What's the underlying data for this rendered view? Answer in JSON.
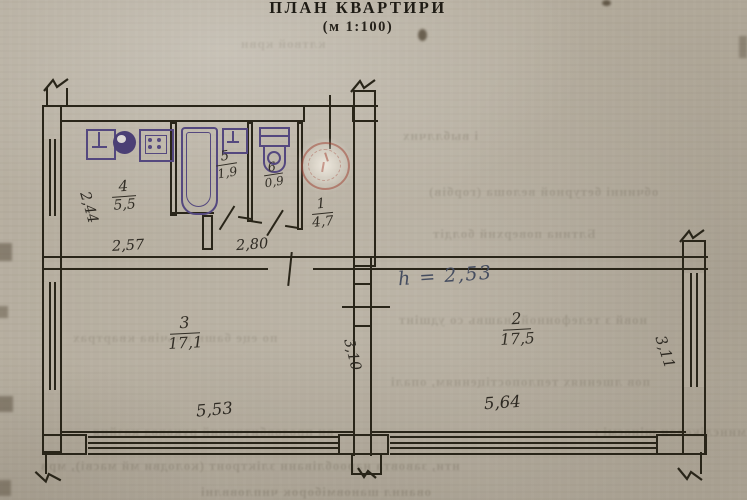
{
  "title": "ПЛАН КВАРТИРИ",
  "scale_note": "(м 1:100)",
  "rooms": [
    {
      "number": "1",
      "area": "4,7"
    },
    {
      "number": "2",
      "area": "17,5"
    },
    {
      "number": "3",
      "area": "17,1"
    },
    {
      "number": "4",
      "area": "5,5"
    },
    {
      "number": "5",
      "area": "1,9"
    },
    {
      "number": "6",
      "area": "0,9"
    }
  ],
  "dimensions": {
    "left_window": "2,44",
    "kitchen_width": "2,57",
    "hall_width": "2,80",
    "room3_depth": "3,10",
    "room3_width": "5,53",
    "room2_width": "5,64",
    "room2_window": "3,11"
  },
  "annotations": {
    "height_note": "h = 2,53"
  },
  "colors": {
    "paper": "#b4ac9d",
    "ink": "#292519",
    "fixture_ink": "#54487f",
    "stamp_red": "#a34a38",
    "pen_ink": "#444c5e"
  },
  "bleedthrough": [
    "клтвой крвн",
    "і выбллчнх",
    "обчинні бетурной велоша (горбів)",
    "Блтина поверхнй болдіт",
    "по еце башн кльчіва квартрах",
    "новй з телефонной інашвь со удшінт",
    "пов лшеннях теплопостіценням, опалі",
    "ви продовбитчивнй руковод казйня",
    "минєлікован шіноємі нарошнодійні",
    "нти, завовта нарообліванн зліктронт (колодви мй масві), мрв",
    "ованнл шановміборок чнпловвлні",
    "б載нтandroid"
  ]
}
